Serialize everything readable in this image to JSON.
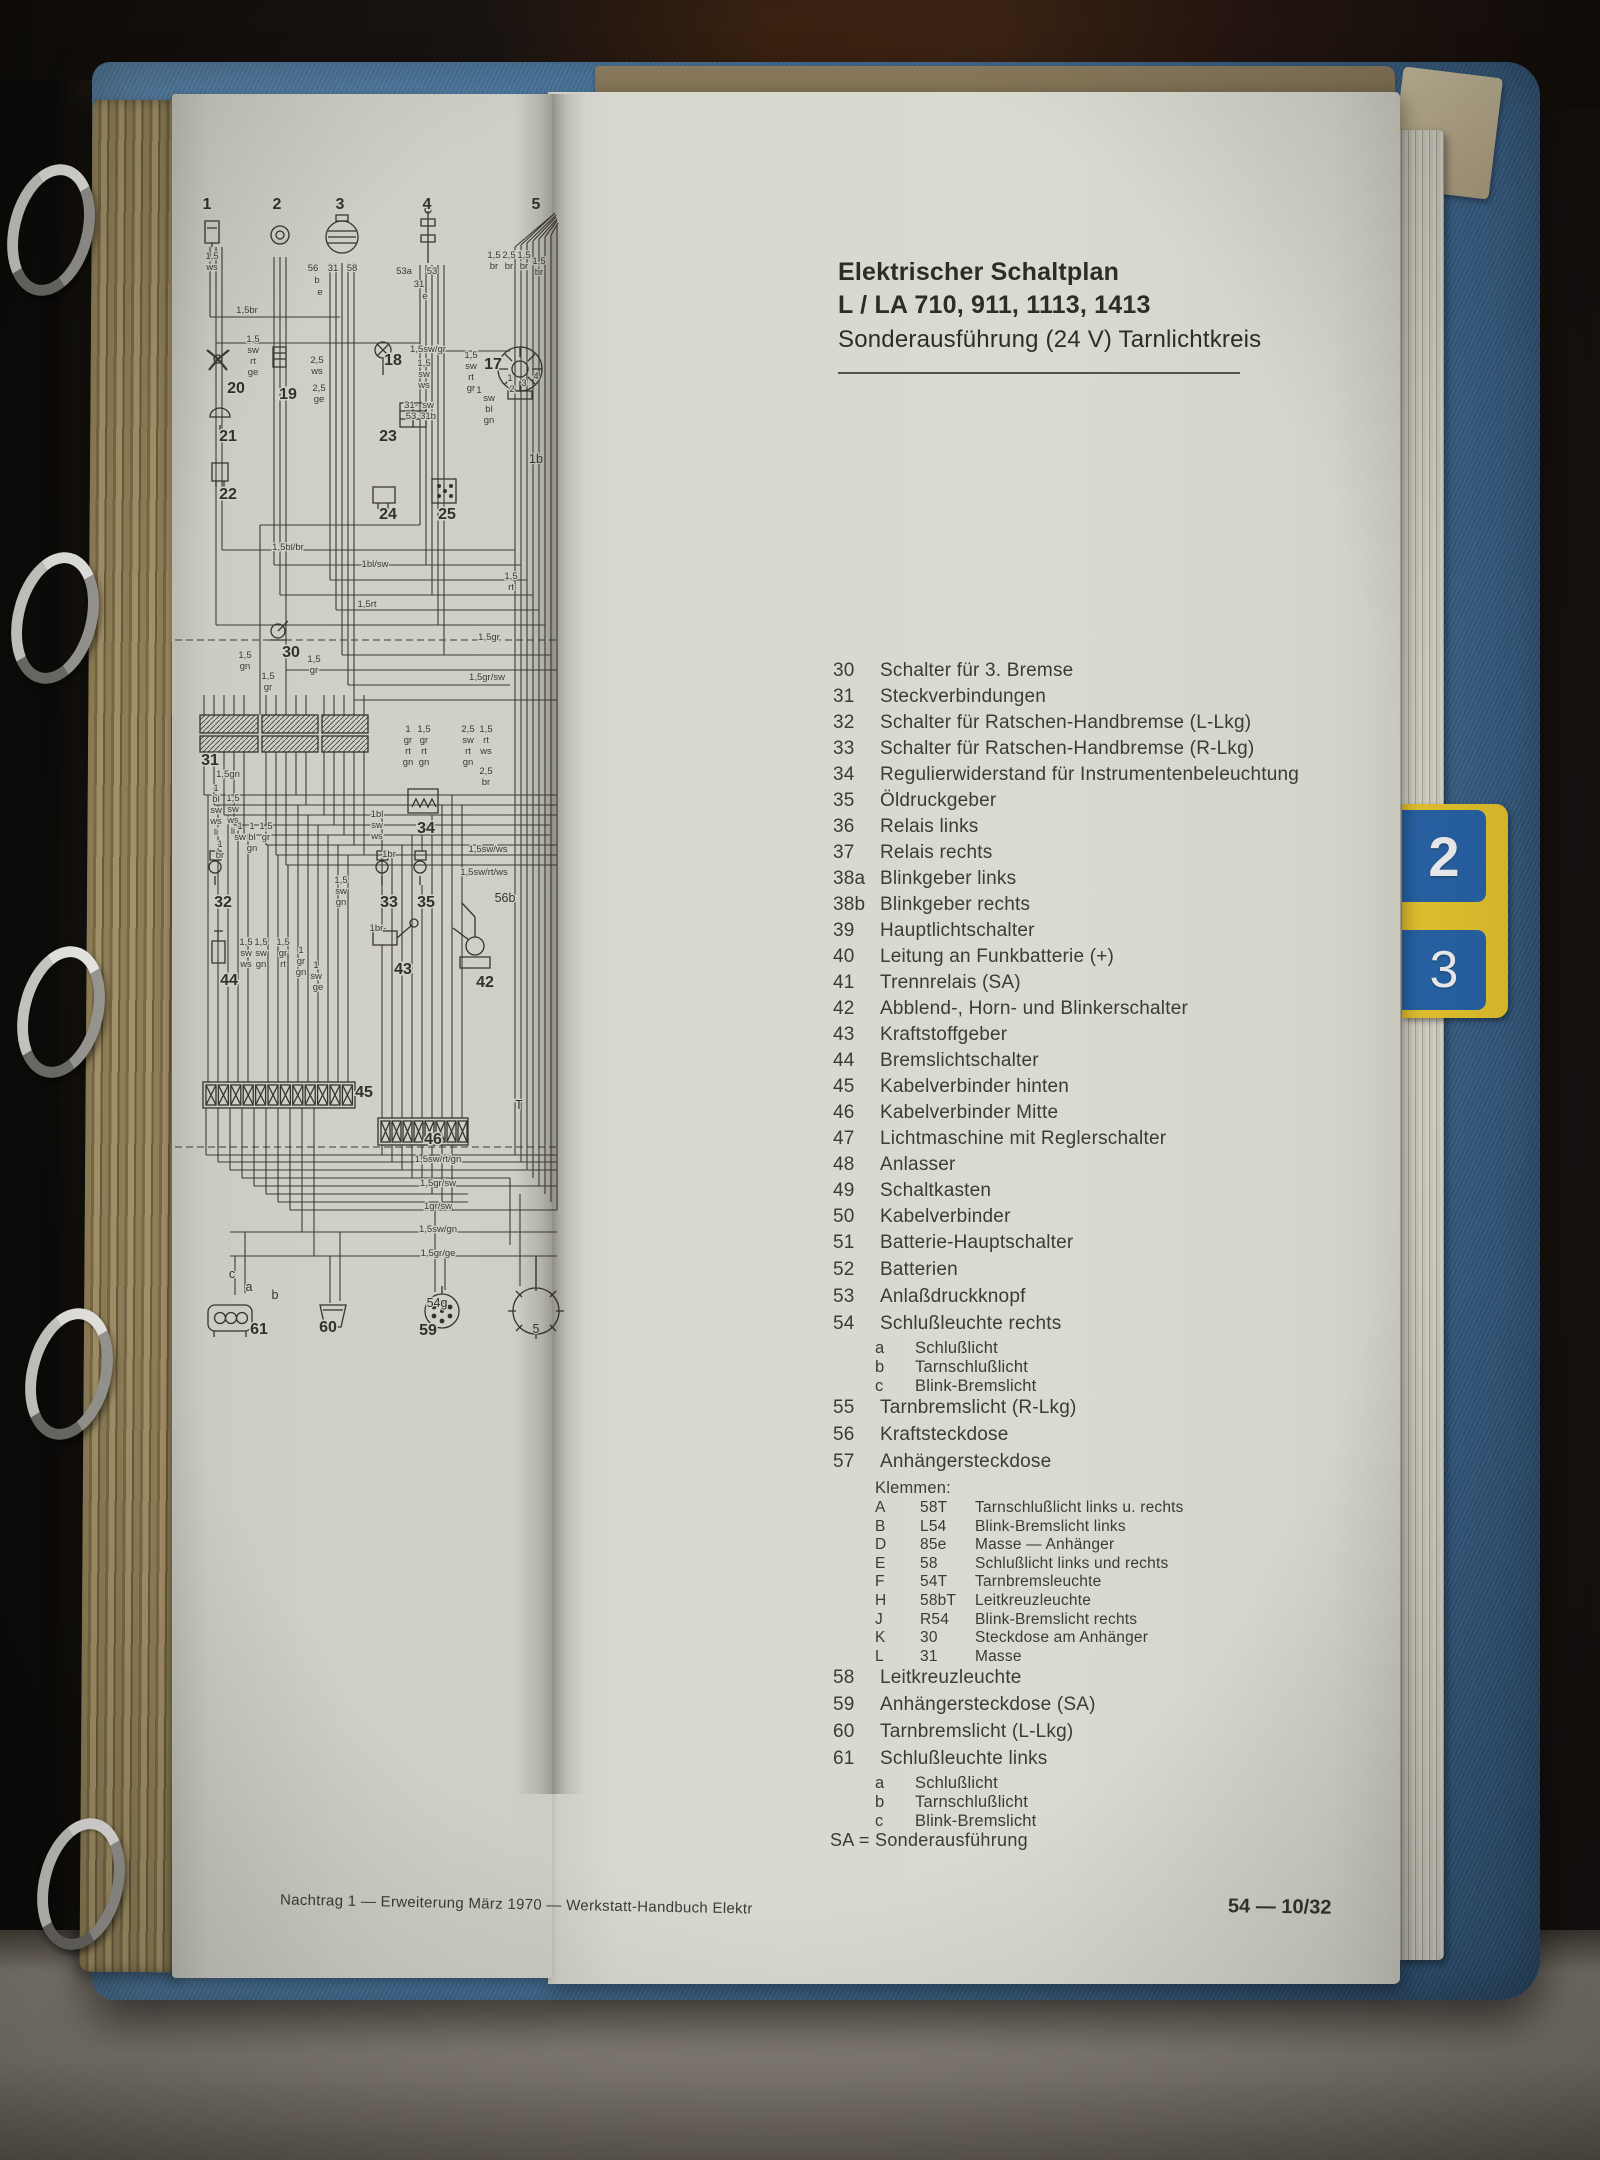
{
  "colors": {
    "binder_blue": "#4a7ba7",
    "tab_yellow": "#e6c52e",
    "tab_blue": "#2563a8",
    "page_cream": "#e2e3dc",
    "diagram_page": "#d8d9d1",
    "ink": "#3b3b35"
  },
  "binder": {
    "tabs": [
      {
        "label": "2"
      },
      {
        "label": "3"
      }
    ]
  },
  "right_page": {
    "title_line1": "Elektrischer Schaltplan",
    "title_line2": "L / LA 710, 911, 1113, 1413",
    "title_line3": "Sonderausführung (24 V) Tarnlichtkreis",
    "sa_note": "SA = Sonderausführung",
    "page_number": "54 — 10/32",
    "legend": {
      "rows": [
        {
          "num": "30",
          "text": "Schalter für 3. Bremse"
        },
        {
          "num": "31",
          "text": "Steckverbindungen"
        },
        {
          "num": "32",
          "text": "Schalter für Ratschen-Handbremse (L-Lkg)"
        },
        {
          "num": "33",
          "text": "Schalter für Ratschen-Handbremse (R-Lkg)"
        },
        {
          "num": "34",
          "text": "Regulierwiderstand für Instrumentenbeleuchtung"
        },
        {
          "num": "35",
          "text": "Öldruckgeber"
        },
        {
          "num": "36",
          "text": "Relais links"
        },
        {
          "num": "37",
          "text": "Relais rechts"
        },
        {
          "num": "38a",
          "text": "Blinkgeber links"
        },
        {
          "num": "38b",
          "text": "Blinkgeber rechts"
        },
        {
          "num": "39",
          "text": "Hauptlichtschalter"
        },
        {
          "num": "40",
          "text": "Leitung an Funkbatterie (+)"
        },
        {
          "num": "41",
          "text": "Trennrelais (SA)"
        },
        {
          "num": "42",
          "text": "Abblend-, Horn- und Blinkerschalter"
        },
        {
          "num": "43",
          "text": "Kraftstoffgeber"
        },
        {
          "num": "44",
          "text": "Bremslichtschalter"
        },
        {
          "num": "45",
          "text": "Kabelverbinder hinten"
        },
        {
          "num": "46",
          "text": "Kabelverbinder Mitte"
        },
        {
          "num": "47",
          "text": "Lichtmaschine mit Reglerschalter"
        },
        {
          "num": "48",
          "text": "Anlasser"
        },
        {
          "num": "49",
          "text": "Schaltkasten"
        },
        {
          "num": "50",
          "text": "Kabelverbinder"
        },
        {
          "num": "51",
          "text": "Batterie-Hauptschalter"
        },
        {
          "num": "52",
          "text": "Batterien"
        },
        {
          "num": "53",
          "text": "Anlaßdruckknopf"
        },
        {
          "num": "54",
          "text": "Schlußleuchte rechts",
          "subs": [
            {
              "k": "a",
              "text": "Schlußlicht"
            },
            {
              "k": "b",
              "text": "Tarnschlußlicht"
            },
            {
              "k": "c",
              "text": "Blink-Bremslicht"
            }
          ]
        },
        {
          "num": "55",
          "text": "Tarnbremslicht (R-Lkg)"
        },
        {
          "num": "56",
          "text": "Kraftsteckdose"
        },
        {
          "num": "57",
          "text": "Anhängersteckdose",
          "klemmen": {
            "heading": "Klemmen:",
            "rows": [
              {
                "k": "A",
                "code": "58T",
                "text": "Tarnschlußlicht links u. rechts"
              },
              {
                "k": "B",
                "code": "L54",
                "text": "Blink-Bremslicht links"
              },
              {
                "k": "D",
                "code": "85e",
                "text": "Masse — Anhänger"
              },
              {
                "k": "E",
                "code": "58",
                "text": "Schlußlicht links und rechts"
              },
              {
                "k": "F",
                "code": "54T",
                "text": "Tarnbremsleuchte"
              },
              {
                "k": "H",
                "code": "58bT",
                "text": "Leitkreuzleuchte"
              },
              {
                "k": "J",
                "code": "R54",
                "text": "Blink-Bremslicht rechts"
              },
              {
                "k": "K",
                "code": "30",
                "text": "Steckdose am Anhänger"
              },
              {
                "k": "L",
                "code": "31",
                "text": "Masse"
              }
            ]
          }
        },
        {
          "num": "58",
          "text": "Leitkreuzleuchte"
        },
        {
          "num": "59",
          "text": "Anhängersteckdose (SA)"
        },
        {
          "num": "60",
          "text": "Tarnbremslicht (L-Lkg)"
        },
        {
          "num": "61",
          "text": "Schlußleuchte links",
          "subs": [
            {
              "k": "a",
              "text": "Schlußlicht"
            },
            {
              "k": "b",
              "text": "Tarnschlußlicht"
            },
            {
              "k": "c",
              "text": "Blink-Bremslicht"
            }
          ]
        }
      ]
    }
  },
  "left_page": {
    "footer": "Nachtrag 1 — Erweiterung März 1970 — Werkstatt-Handbuch Elektr",
    "diagram": {
      "numbers": [
        [
          207,
          209,
          "1"
        ],
        [
          277,
          209,
          "2"
        ],
        [
          340,
          209,
          "3"
        ],
        [
          427,
          209,
          "4"
        ],
        [
          536,
          209,
          "5"
        ],
        [
          493,
          369,
          "17"
        ],
        [
          393,
          365,
          "18"
        ],
        [
          288,
          399,
          "19"
        ],
        [
          236,
          393,
          "20"
        ],
        [
          228,
          441,
          "21"
        ],
        [
          228,
          499,
          "22"
        ],
        [
          388,
          441,
          "23"
        ],
        [
          388,
          519,
          "24"
        ],
        [
          447,
          519,
          "25"
        ],
        [
          291,
          657,
          "30"
        ],
        [
          210,
          765,
          "31"
        ],
        [
          223,
          907,
          "32"
        ],
        [
          389,
          907,
          "33"
        ],
        [
          426,
          833,
          "34"
        ],
        [
          426,
          907,
          "35"
        ],
        [
          229,
          985,
          "44"
        ],
        [
          403,
          974,
          "43"
        ],
        [
          485,
          987,
          "42"
        ],
        [
          364,
          1097,
          "45"
        ],
        [
          433,
          1144,
          "46"
        ],
        [
          259,
          1334,
          "61"
        ],
        [
          328,
          1332,
          "60"
        ],
        [
          428,
          1335,
          "59"
        ]
      ],
      "marks": [
        [
          232,
          1278,
          "c"
        ],
        [
          249,
          1291,
          "a"
        ],
        [
          275,
          1299,
          "b"
        ],
        [
          437,
          1307,
          "54g"
        ],
        [
          505,
          902,
          "56b"
        ],
        [
          519,
          1109,
          "T"
        ],
        [
          536,
          463,
          "1b"
        ],
        [
          536,
          1333,
          "5"
        ]
      ],
      "labels": [
        [
          212,
          259,
          "1,5"
        ],
        [
          212,
          270,
          "ws"
        ],
        [
          247,
          313,
          "1,5br"
        ],
        [
          253,
          342,
          "1,5"
        ],
        [
          253,
          353,
          "sw"
        ],
        [
          253,
          364,
          "rt"
        ],
        [
          253,
          375,
          "ge"
        ],
        [
          313,
          271,
          "56"
        ],
        [
          333,
          271,
          "31"
        ],
        [
          352,
          271,
          "58"
        ],
        [
          317,
          283,
          "b"
        ],
        [
          320,
          295,
          "e"
        ],
        [
          404,
          274,
          "53a"
        ],
        [
          432,
          274,
          "53"
        ],
        [
          419,
          287,
          "31"
        ],
        [
          425,
          299,
          "e"
        ],
        [
          494,
          258,
          "1,5"
        ],
        [
          509,
          258,
          "2,5"
        ],
        [
          524,
          258,
          "1,5"
        ],
        [
          494,
          269,
          "br"
        ],
        [
          509,
          269,
          "br"
        ],
        [
          524,
          269,
          "br"
        ],
        [
          539,
          264,
          "1,5"
        ],
        [
          539,
          275,
          "br"
        ],
        [
          317,
          363,
          "2,5"
        ],
        [
          317,
          374,
          "ws"
        ],
        [
          319,
          391,
          "2,5"
        ],
        [
          319,
          402,
          "ge"
        ],
        [
          428,
          352,
          "1,5sw/gr"
        ],
        [
          424,
          366,
          "1,5"
        ],
        [
          424,
          377,
          "sw"
        ],
        [
          424,
          388,
          "ws"
        ],
        [
          471,
          358,
          "1,5"
        ],
        [
          471,
          369,
          "sw"
        ],
        [
          471,
          380,
          "rt"
        ],
        [
          471,
          391,
          "gr"
        ],
        [
          411,
          408,
          "31-"
        ],
        [
          428,
          408,
          "sw"
        ],
        [
          411,
          419,
          "53"
        ],
        [
          428,
          419,
          "31b"
        ],
        [
          479,
          393,
          "1"
        ],
        [
          489,
          401,
          "sw"
        ],
        [
          489,
          412,
          "bl"
        ],
        [
          489,
          423,
          "gn"
        ],
        [
          510,
          381,
          "1"
        ],
        [
          512,
          392,
          "2"
        ],
        [
          524,
          386,
          "3"
        ],
        [
          536,
          379,
          "4"
        ],
        [
          511,
          579,
          "1,5"
        ],
        [
          511,
          590,
          "rt"
        ],
        [
          288,
          550,
          "1,5bl/br"
        ],
        [
          375,
          567,
          "1bl/sw"
        ],
        [
          367,
          607,
          "1,5rt"
        ],
        [
          489,
          640,
          "1,5gr"
        ],
        [
          245,
          658,
          "1,5"
        ],
        [
          245,
          669,
          "gn"
        ],
        [
          268,
          679,
          "1,5"
        ],
        [
          268,
          690,
          "gr"
        ],
        [
          314,
          662,
          "1,5"
        ],
        [
          314,
          673,
          "gr"
        ],
        [
          487,
          680,
          "1,5gr/sw"
        ],
        [
          408,
          732,
          "1"
        ],
        [
          408,
          743,
          "gr"
        ],
        [
          408,
          754,
          "rt"
        ],
        [
          408,
          765,
          "gn"
        ],
        [
          424,
          732,
          "1,5"
        ],
        [
          424,
          743,
          "gr"
        ],
        [
          424,
          754,
          "rt"
        ],
        [
          424,
          765,
          "gn"
        ],
        [
          468,
          732,
          "2,5"
        ],
        [
          468,
          743,
          "sw"
        ],
        [
          468,
          754,
          "rt"
        ],
        [
          468,
          765,
          "gn"
        ],
        [
          486,
          732,
          "1,5"
        ],
        [
          486,
          743,
          "rt"
        ],
        [
          486,
          754,
          "ws"
        ],
        [
          486,
          774,
          "2,5"
        ],
        [
          486,
          785,
          "br"
        ],
        [
          228,
          777,
          "1,5gn"
        ],
        [
          216,
          791,
          "1"
        ],
        [
          216,
          802,
          "bl"
        ],
        [
          216,
          813,
          "sw"
        ],
        [
          216,
          824,
          "ws"
        ],
        [
          216,
          835,
          "li"
        ],
        [
          233,
          801,
          "1,5"
        ],
        [
          233,
          812,
          "sw"
        ],
        [
          233,
          823,
          "ws"
        ],
        [
          233,
          834,
          "li"
        ],
        [
          220,
          847,
          "1"
        ],
        [
          220,
          858,
          "br"
        ],
        [
          240,
          829,
          "1"
        ],
        [
          240,
          840,
          "sw"
        ],
        [
          252,
          829,
          "1"
        ],
        [
          252,
          840,
          "bl"
        ],
        [
          266,
          829,
          "1,5"
        ],
        [
          266,
          840,
          "gr"
        ],
        [
          252,
          851,
          "gn"
        ],
        [
          377,
          817,
          "1bl"
        ],
        [
          377,
          828,
          "sw"
        ],
        [
          377,
          839,
          "ws"
        ],
        [
          389,
          857,
          "1br"
        ],
        [
          488,
          852,
          "1,5sw/ws"
        ],
        [
          484,
          875,
          "1,5sw/rt/ws"
        ],
        [
          341,
          883,
          "1,5"
        ],
        [
          341,
          894,
          "sw"
        ],
        [
          341,
          905,
          "gn"
        ],
        [
          378,
          931,
          "1br-"
        ],
        [
          246,
          945,
          "1,5"
        ],
        [
          246,
          956,
          "sw"
        ],
        [
          246,
          967,
          "ws"
        ],
        [
          261,
          945,
          "1,5"
        ],
        [
          261,
          956,
          "sw"
        ],
        [
          261,
          967,
          "gn"
        ],
        [
          283,
          945,
          "1,5"
        ],
        [
          283,
          956,
          "gr"
        ],
        [
          283,
          967,
          "rt"
        ],
        [
          301,
          953,
          "1"
        ],
        [
          301,
          964,
          "gr"
        ],
        [
          301,
          975,
          "gn"
        ],
        [
          316,
          968,
          "1"
        ],
        [
          316,
          979,
          "sw"
        ],
        [
          318,
          990,
          "ge"
        ],
        [
          438,
          1162,
          "1,5sw/rt/gn"
        ],
        [
          438,
          1186,
          "1,5gr/sw"
        ],
        [
          438,
          1209,
          "1gr/sw"
        ],
        [
          438,
          1232,
          "1,5sw/gn"
        ],
        [
          438,
          1256,
          "1,5gr/ge"
        ]
      ]
    }
  }
}
